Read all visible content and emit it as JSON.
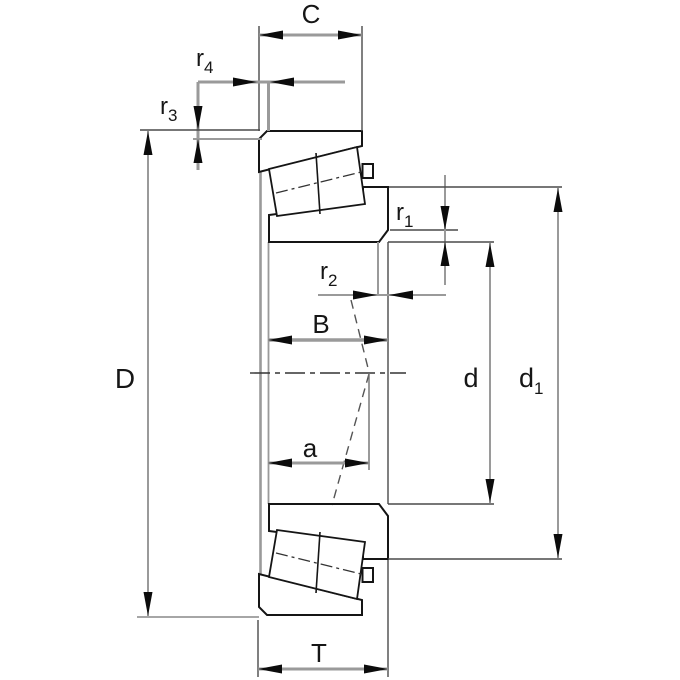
{
  "drawing": {
    "description": "tapered-roller-bearing-cross-section-dimension-drawing",
    "labels": {
      "C": {
        "text": "C"
      },
      "r4": {
        "main": "r",
        "sub": "4"
      },
      "r3": {
        "main": "r",
        "sub": "3"
      },
      "D": {
        "text": "D"
      },
      "r1": {
        "main": "r",
        "sub": "1"
      },
      "r2": {
        "main": "r",
        "sub": "2"
      },
      "B": {
        "text": "B"
      },
      "a": {
        "text": "a"
      },
      "d": {
        "text": "d"
      },
      "d1": {
        "main": "d",
        "sub": "1"
      },
      "T": {
        "text": "T"
      }
    },
    "colors": {
      "background": "#ffffff",
      "outline": "#151515",
      "dimension_gray": "#9a9a9a",
      "hatch": "#3a3a3a"
    }
  }
}
